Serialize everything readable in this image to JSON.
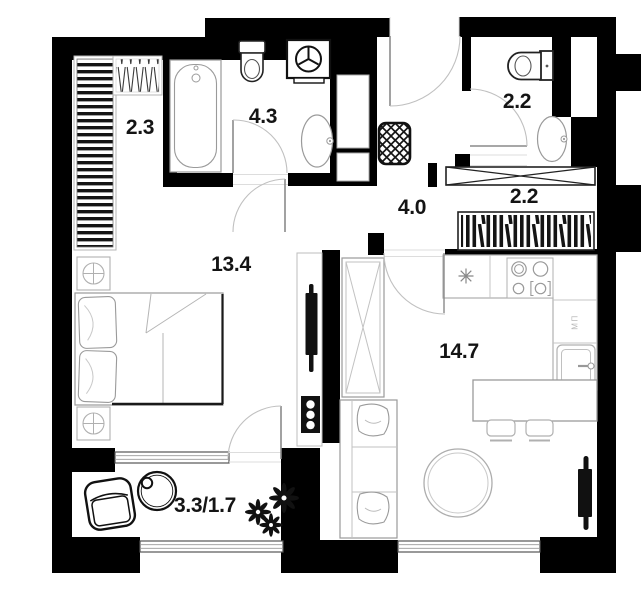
{
  "plan_type": "apartment-floor-plan",
  "colors": {
    "wall": "#000000",
    "background": "#ffffff",
    "furniture_line": "#9a9a9a",
    "bold_line": "#111111"
  },
  "room_labels": [
    {
      "room": "wardrobe",
      "text": "2.3"
    },
    {
      "room": "bathroom",
      "text": "4.3"
    },
    {
      "room": "wc",
      "text": "2.2"
    },
    {
      "room": "hall-closet",
      "text": "2.2"
    },
    {
      "room": "hallway",
      "text": "4.0"
    },
    {
      "room": "bedroom",
      "text": "13.4"
    },
    {
      "room": "kitchen-living-room",
      "text": "14.7"
    },
    {
      "room": "balcony",
      "text": "3.3/1.7"
    }
  ],
  "annotations": [
    {
      "id": "appliance-slot",
      "text": "МП"
    }
  ]
}
